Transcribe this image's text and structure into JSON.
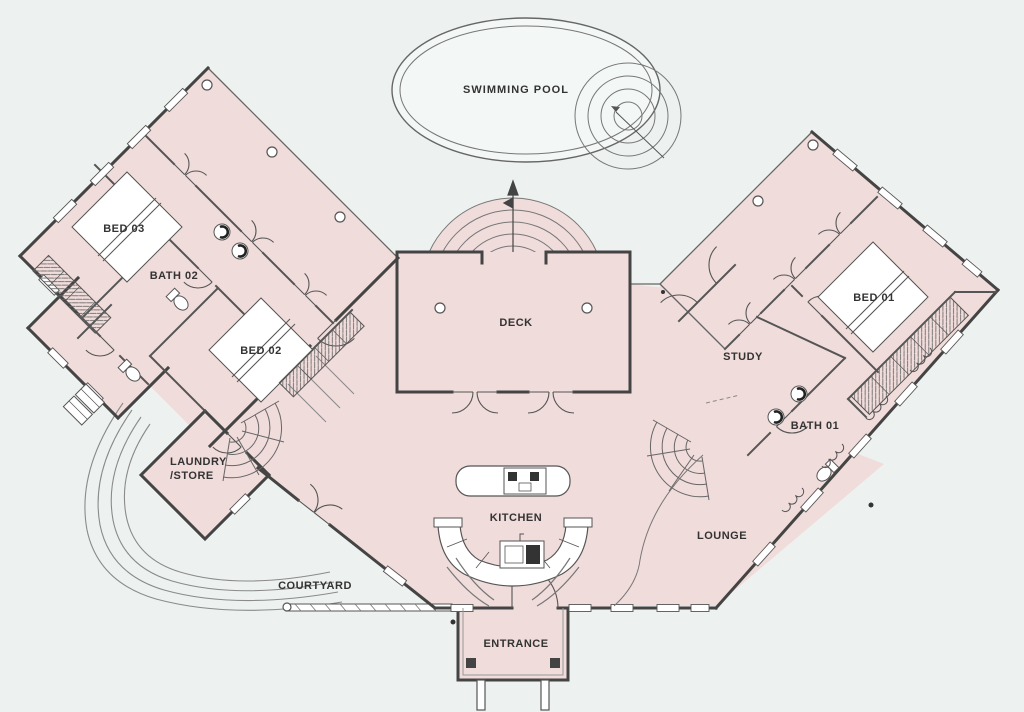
{
  "plan": {
    "title": "House floor plan",
    "labels": {
      "pool": "SWIMMING POOL",
      "bed03": "BED 03",
      "bath02": "BATH 02",
      "bed02": "BED 02",
      "laundry_line1": "LAUNDRY",
      "laundry_line2": "/STORE",
      "deck": "DECK",
      "kitchen": "KITCHEN",
      "study": "STUDY",
      "bed01": "BED 01",
      "bath01": "BATH 01",
      "lounge": "LOUNGE",
      "courtyard": "COURTYARD",
      "entrance": "ENTRANCE"
    },
    "colors": {
      "background": "#edf2f0",
      "floor": "#f0dcda",
      "wall": "#444444",
      "thin_line": "#777777",
      "pool_fill": "#f3f7f5",
      "label": "#333333"
    }
  }
}
